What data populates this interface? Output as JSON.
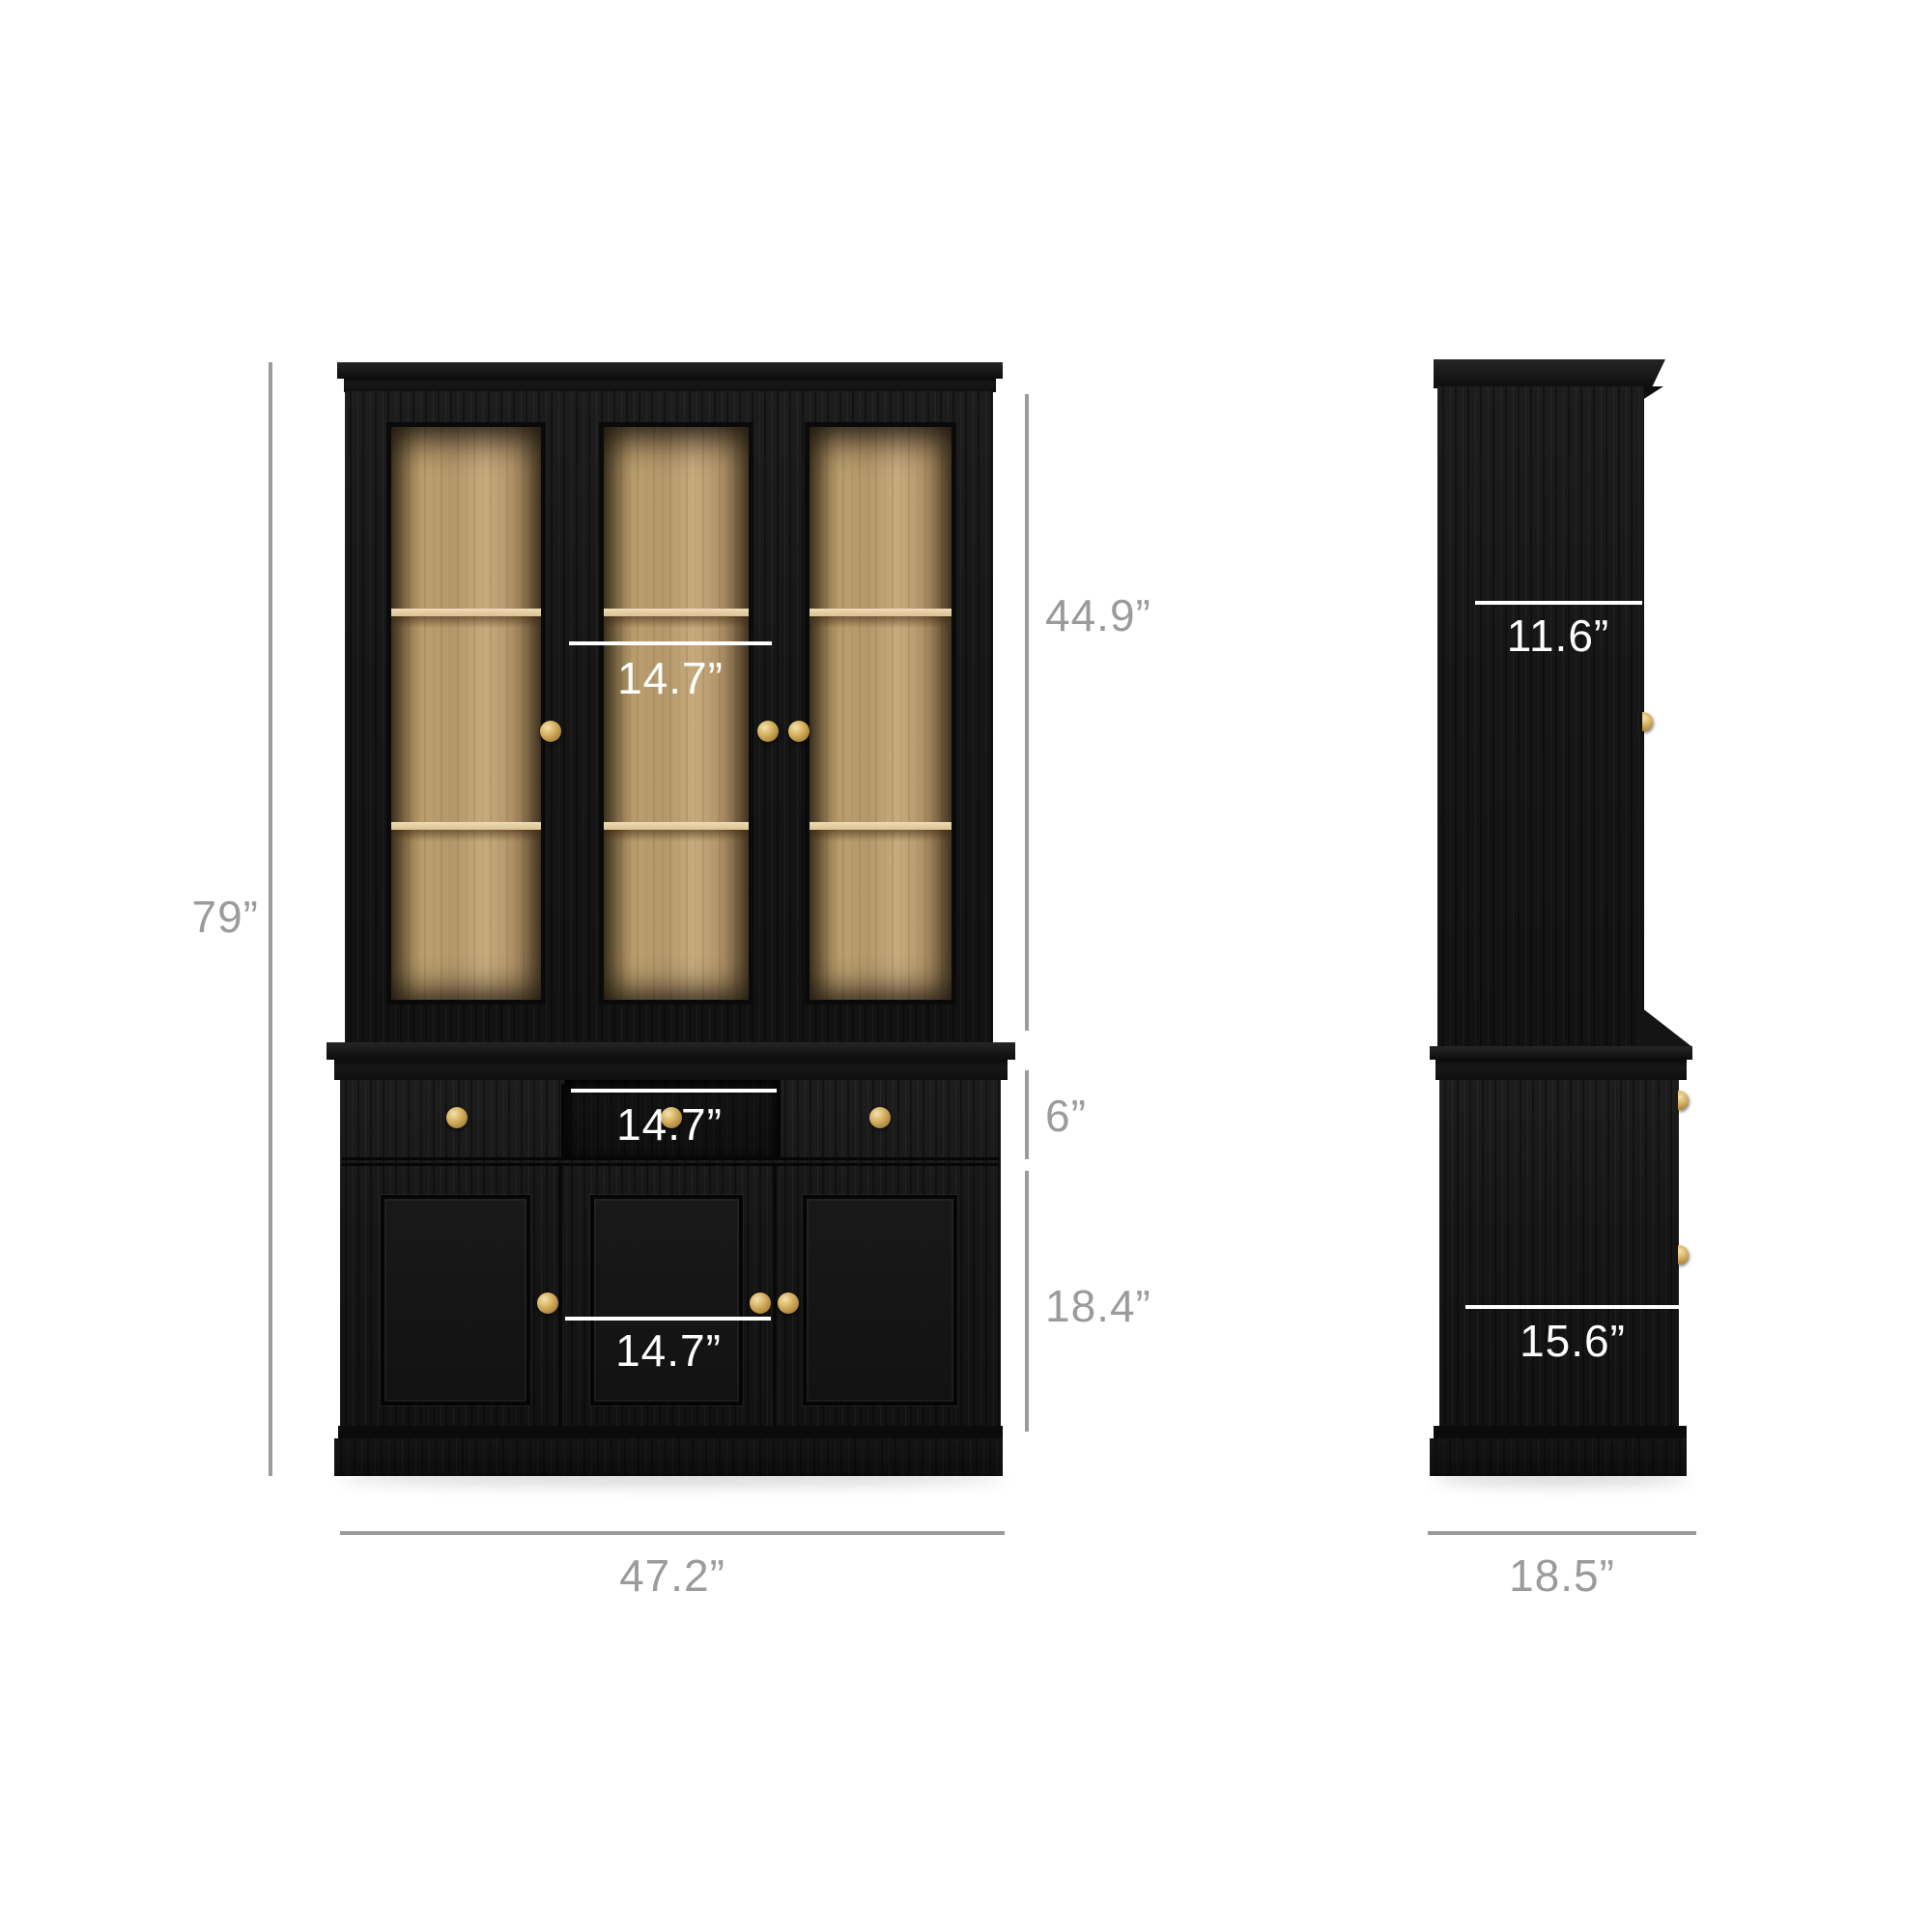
{
  "diagram": {
    "type": "furniture-dimension-diagram",
    "subject": "black hutch cabinet with glass doors, front and side views",
    "front": {
      "overall_height": "79”",
      "hutch_height": "44.9”",
      "hutch_door_width": "14.7”",
      "drawer_height": "6”",
      "drawer_width": "14.7”",
      "door_section_height": "18.4”",
      "door_width": "14.7”",
      "overall_width": "47.2”"
    },
    "side": {
      "hutch_depth": "11.6”",
      "base_depth": "15.6”",
      "overall_depth": "18.5”"
    },
    "colors": {
      "dimension_gray": "#9b9b9b",
      "dimension_white": "#ffffff",
      "cabinet_black": "#161616",
      "oak_interior": "#b4976b",
      "brass_knob": "#dab768",
      "background": "#ffffff"
    }
  }
}
